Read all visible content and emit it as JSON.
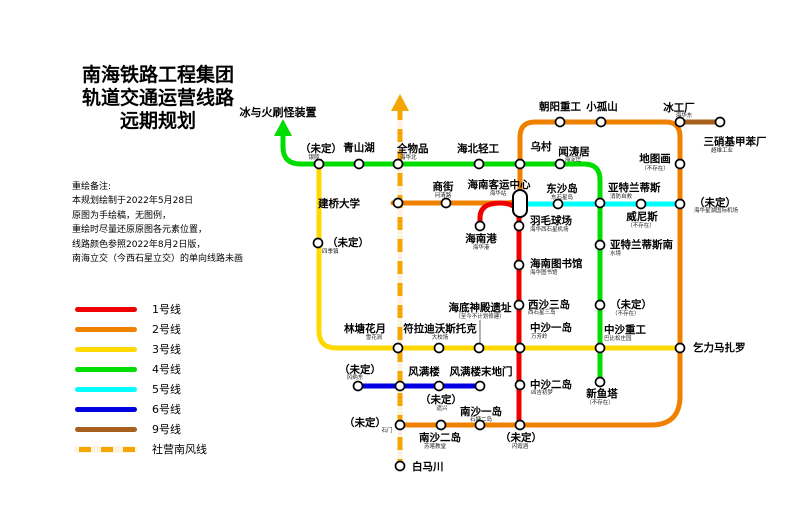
{
  "title": {
    "line1": "南海铁路工程集团",
    "line2": "轨道交通运营线路",
    "line3": "远期规划"
  },
  "notes": {
    "heading": "重绘备注:",
    "line1": "本规划绘制于2022年5月28日",
    "line2": "原图为手绘稿，无图例，",
    "line3": "重绘时尽量还原原图各元素位置，",
    "line4": "线路颜色参照2022年8月2日版，",
    "line5": "南海立交（今西石星立交）的单向线路未画"
  },
  "lines": [
    {
      "label": "1号线",
      "color": "#ee0000"
    },
    {
      "label": "2号线",
      "color": "#f08000"
    },
    {
      "label": "3号线",
      "color": "#ffd800"
    },
    {
      "label": "4号线",
      "color": "#00dd00"
    },
    {
      "label": "5号线",
      "color": "#00ffff"
    },
    {
      "label": "6号线",
      "color": "#0000e0"
    },
    {
      "label": "9号线",
      "color": "#a8601e"
    },
    {
      "label": "社营南风线",
      "color": "#f6a600",
      "style": "dashed"
    }
  ],
  "annotations": {
    "spawner_label": "冰与火刷怪装置"
  },
  "stations": [
    {
      "name": "（未定）",
      "sub": "银陵"
    },
    {
      "name": "青山湖"
    },
    {
      "name": "全物品",
      "sub": "海华北"
    },
    {
      "name": "海北轻工"
    },
    {
      "name": "乌村"
    },
    {
      "name": "闻涛居",
      "sub": "海淀庄"
    },
    {
      "name": "朝阳重工"
    },
    {
      "name": "小孤山"
    },
    {
      "name": "冰工厂",
      "sub": "海华东"
    },
    {
      "name": "三硝基甲苯厂",
      "sub": "超维工业"
    },
    {
      "name": "地图画",
      "sub": "（不存在）"
    },
    {
      "name": "商街",
      "sub": "问清路"
    },
    {
      "name": "建桥大学"
    },
    {
      "name": "海南客运中心",
      "sub": "海华站"
    },
    {
      "name": "东沙岛",
      "sub": "东石星岛"
    },
    {
      "name": "亚特兰蒂斯",
      "sub": "消防自救"
    },
    {
      "name": "威尼斯",
      "sub": "（不存在）"
    },
    {
      "name": "（未定）",
      "sub": "海华星湖国际机场"
    },
    {
      "name": "海南港",
      "sub": "海华港"
    },
    {
      "name": "羽毛球场",
      "sub": "海华西石星机场"
    },
    {
      "name": "海南图书馆",
      "sub": "海华图书馆"
    },
    {
      "name": "亚特兰蒂斯南",
      "sub": "水境"
    },
    {
      "name": "（未定）",
      "sub": "四季镇"
    },
    {
      "name": "（未定）",
      "sub": "（不存在）"
    },
    {
      "name": "西沙三岛",
      "sub": "西石星三岛"
    },
    {
      "name": "海底神殿遗址",
      "sub": "（至今不计划修建）"
    },
    {
      "name": "符拉迪沃斯托克",
      "sub": "大校场"
    },
    {
      "name": "林塘花月",
      "sub": "雪花涧"
    },
    {
      "name": "中沙一岛",
      "sub": "万芳岭"
    },
    {
      "name": "中沙重工",
      "sub": "巴比松庄园"
    },
    {
      "name": "乞力马扎罗"
    },
    {
      "name": "（未定）",
      "sub": "风纳东"
    },
    {
      "name": "风满楼"
    },
    {
      "name": "（未定）",
      "sub": "遗兴"
    },
    {
      "name": "风满楼末地门"
    },
    {
      "name": "中沙二岛",
      "sub": "凶吉初梦"
    },
    {
      "name": "新鱼塔",
      "sub": "（不存在）"
    },
    {
      "name": "（未定）",
      "sub": "石门"
    },
    {
      "name": "南沙二岛",
      "sub": "苏喀教堂"
    },
    {
      "name": "南沙一岛",
      "sub": "石塘二岛"
    },
    {
      "name": "（未定）",
      "sub": "闪霞酒"
    },
    {
      "name": "白马川"
    }
  ]
}
